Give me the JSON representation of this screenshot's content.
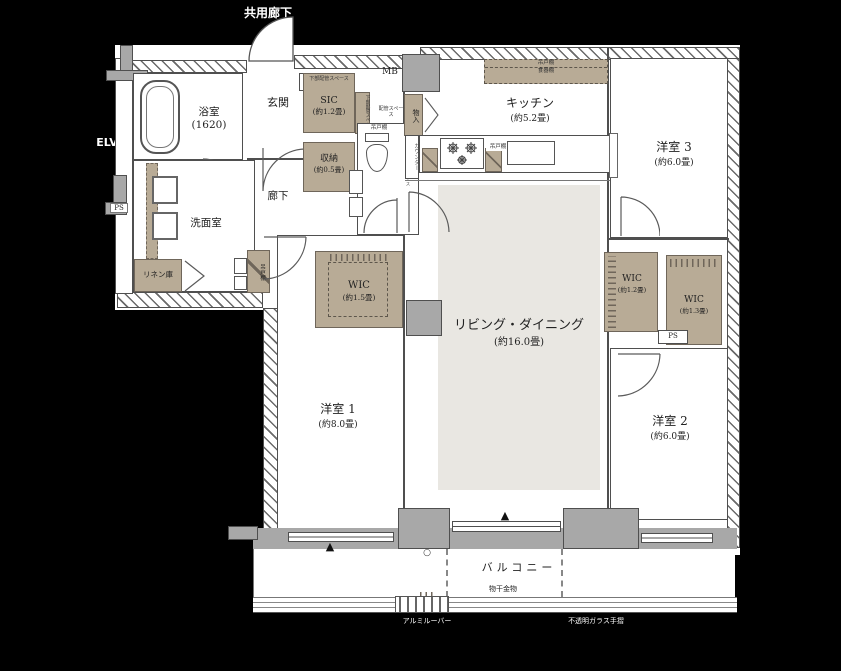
{
  "colors": {
    "background": "#000000",
    "tan_storage": "#b8ab96",
    "living_floor": "#e9e7e2",
    "wall_gray": "#a8a8a8",
    "line": "#4f4f4f"
  },
  "exterior": {
    "shared_corridor": "共用廊下",
    "elevator": "ELV"
  },
  "rooms": {
    "bath": {
      "name": "浴室",
      "size": "(1620)"
    },
    "washroom": {
      "name": "洗面室"
    },
    "linen": {
      "name": "リネン庫"
    },
    "entrance": {
      "name": "玄関"
    },
    "hallway": {
      "name": "廊下"
    },
    "sic": {
      "name": "SIC",
      "size": "(約1.2畳)"
    },
    "storage": {
      "name": "収納",
      "size": "(約0.5畳)"
    },
    "kitchen": {
      "name": "キッチン",
      "size": "(約5.2畳)"
    },
    "living": {
      "name": "リビング・ダイニング",
      "size": "(約16.0畳)"
    },
    "bedroom1": {
      "name": "洋室 1",
      "size": "(約8.0畳)"
    },
    "bedroom2": {
      "name": "洋室 2",
      "size": "(約6.0畳)"
    },
    "bedroom3": {
      "name": "洋室 3",
      "size": "(約6.0畳)"
    },
    "wic_a": {
      "name": "WIC",
      "size": "(約1.5畳)"
    },
    "wic_b": {
      "name": "WIC",
      "size": "(約1.2畳)"
    },
    "wic_c": {
      "name": "WIC",
      "size": "(約1.3畳)"
    }
  },
  "fixtures": {
    "ps": "PS",
    "mb": "MB",
    "mono_ire": "物入",
    "counter": "カウンター",
    "hanging_cupboard": "吊戸棚",
    "dish_cupboard": "食器棚",
    "lower_piping_space": "下部配管スペース",
    "piping_space": "配管スペース"
  },
  "balcony": {
    "name": "バルコニー",
    "laundry_hardware": "物干金物",
    "aluminum_louver": "アルミルーバー",
    "opaque_glass_railing": "不透明ガラス手摺"
  },
  "markers": {
    "hatch_triangle": "▲",
    "drain_circle": "○"
  }
}
